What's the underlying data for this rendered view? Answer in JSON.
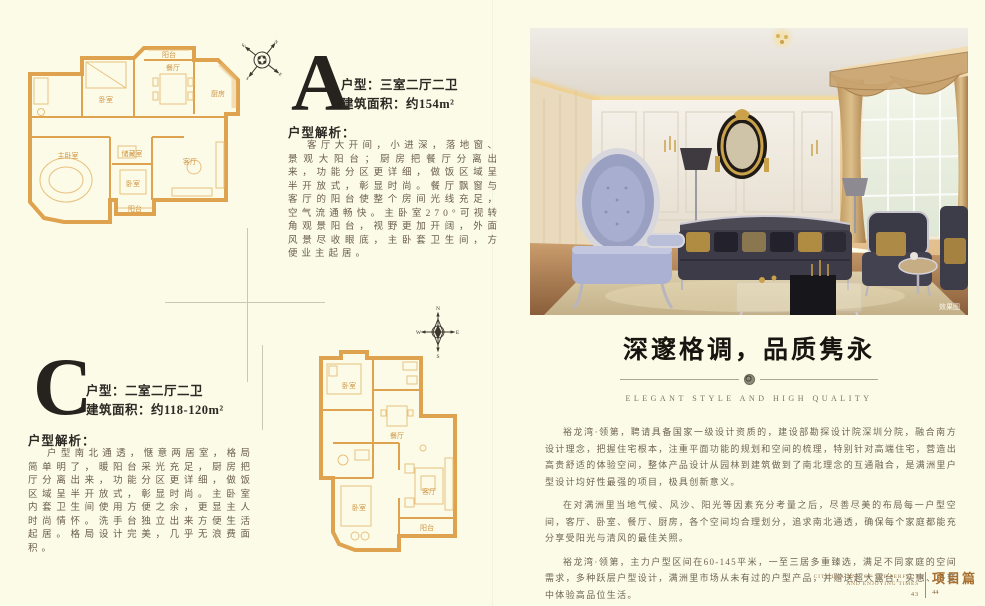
{
  "plan_a": {
    "letter": "A",
    "spec_type": "户型：三室二厅二卫",
    "spec_area": "建筑面积：约154m²",
    "analysis_title": "户型解析：",
    "analysis_text": "客厅大开间，小进深，落地窗、景观大阳台；厨房把餐厅分离出来，功能分区更详细，做饭区域呈半开放式，彰显时尚。餐厅飘窗与客厅的阳台使整个房间光线充足，空气流通畅快。主卧室270°可视转角观景阳台，视野更加开阔，外面风景尽收眼底，主卧套卫生间，方便业主起居。",
    "rooms": {
      "balcony_top": "阳台",
      "bedroom2": "卧室",
      "dining": "餐厅",
      "kitchen": "厨房",
      "master": "主卧室",
      "storage": "储藏室",
      "bedroom3": "卧室",
      "living": "客厅",
      "balcony_bottom": "阳台"
    }
  },
  "plan_c": {
    "letter": "C",
    "spec_type": "户型：二室二厅二卫",
    "spec_area": "建筑面积：约118-120m²",
    "analysis_title": "户型解析：",
    "analysis_text": "户型南北通透，惬意两居室，格局简单明了，暖阳台采光充足，厨房把厅分离出来，功能分区更详细，做饭区域呈半开放式，彰显时尚。主卧室内套卫生间使用方便之余，更显主人时尚情怀。洗手台独立出来方便生活起居。格局设计完美，几乎无浪费面积。",
    "rooms": {
      "bedroom_top": "卧室",
      "dining": "餐厅",
      "living": "客厅",
      "bedroom_bottom": "卧室",
      "balcony": "阳台"
    }
  },
  "compass": {
    "n": "N",
    "e": "E",
    "s": "S",
    "w": "W"
  },
  "photo": {
    "caption": "效果图"
  },
  "feature": {
    "headline": "深邃格调，品质隽永",
    "subheadline": "ELEGANT STYLE AND HIGH QUALITY",
    "paragraphs": [
      "裕龙湾·领第，聘请具备国家一级设计资质的，建设部勘探设计院深圳分院，融合南方设计理念，把握住宅根本，注重平面功能的规划和空间的梳理，特别针对高端住宅，营造出高贵舒适的体验空间，整体产品设计从园林到建筑做到了南北理念的互通融合，是满洲里户型设计均好性最强的项目，极具创新意义。",
      "在对满洲里当地气候、风沙、阳光等因素充分考量之后，尽善尽美的布局每一户型空间，客厅、卧室、餐厅、厨房，各个空间均合理划分，追求南北通透，确保每个家庭都能充分享受阳光与清风的最佳关照。",
      "裕龙湾·领第，主力户型区间在60-145平米，一至三居多重臻选，满足不同家庭的空间需求，多种跃层户型设计，满洲里市场从未有过的户型产品，并赠送超大露台，实惠、多变中体验高品位生活。"
    ]
  },
  "footer": {
    "tagline_line1": "CITY LEADING OF THE PERFECT",
    "tagline_line2": "AND ENJOYING TIMES",
    "page_left": "43",
    "page_right": "44",
    "section_label": "项目篇"
  }
}
